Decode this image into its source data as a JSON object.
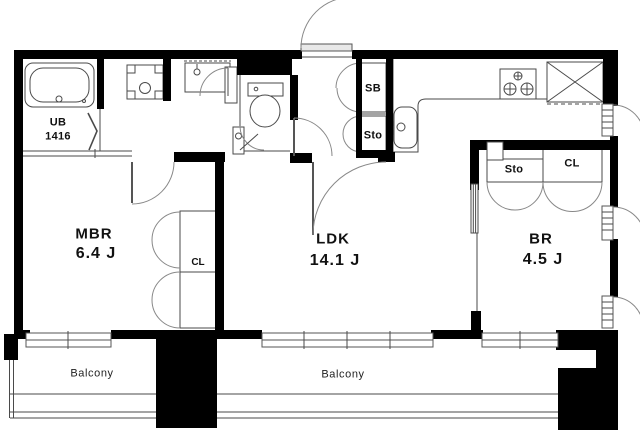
{
  "fp": {
    "rooms": {
      "mbr": {
        "name": "MBR",
        "size": "6.4 J"
      },
      "ldk": {
        "name": "LDK",
        "size": "14.1 J"
      },
      "br": {
        "name": "BR",
        "size": "4.5 J"
      }
    },
    "labels": {
      "unit_bath": "UB",
      "unit_bath_size": "1416",
      "shoe_box": "SB",
      "hall_storage": "Sto",
      "br_storage": "Sto",
      "mbr_closet": "CL",
      "br_closet": "CL",
      "balcony_left": "Balcony",
      "balcony_right": "Balcony"
    },
    "colors": {
      "wall": "#000000",
      "line": "#4a4a4a",
      "door_arc": "#888888",
      "background": "#ffffff",
      "text": "#111111"
    }
  }
}
